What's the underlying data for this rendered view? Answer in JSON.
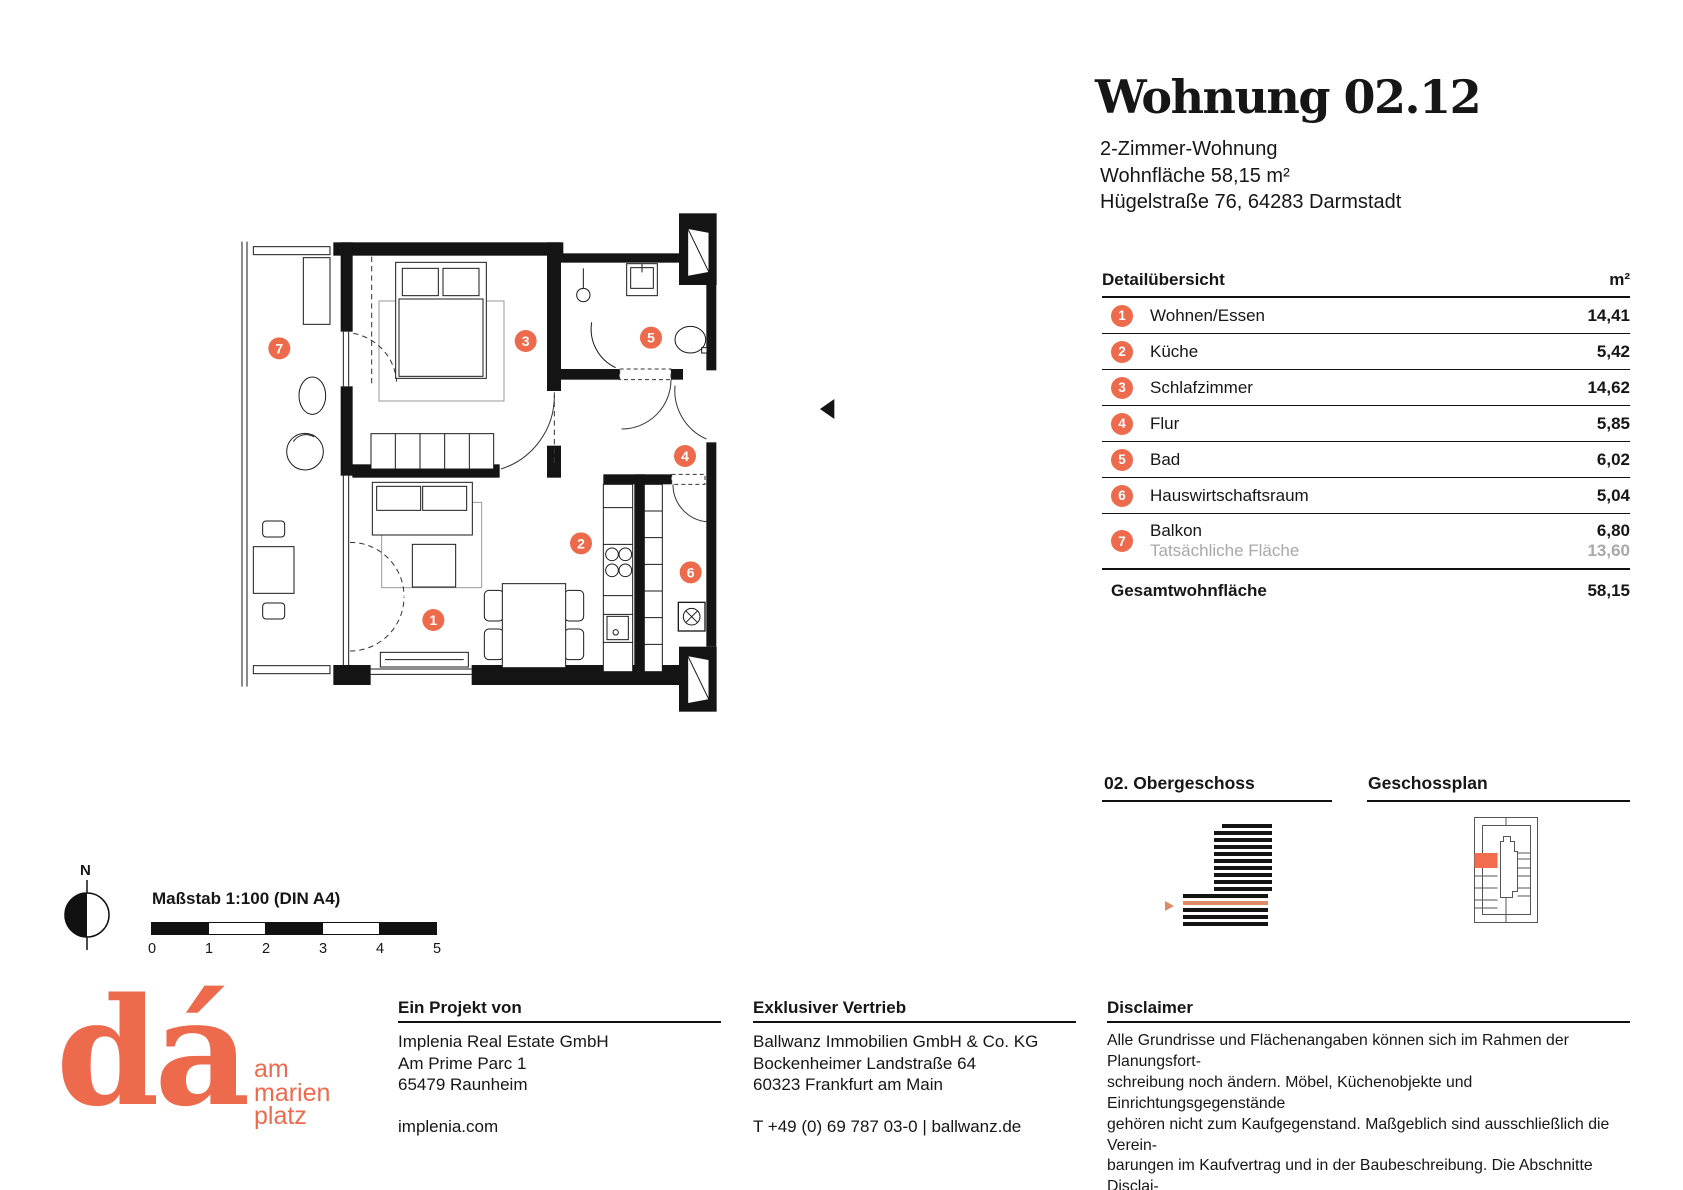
{
  "accent": "#ED6A4C",
  "stripe_orange": "#DE8A66",
  "header": {
    "title": "Wohnung 02.12",
    "lines": [
      "2-Zimmer-Wohnung",
      "Wohnfläche 58,15 m²",
      "Hügelstraße 76, 64283 Darmstadt"
    ]
  },
  "table": {
    "title": "Detailübersicht",
    "unit": "m²",
    "rows": [
      {
        "num": "1",
        "label": "Wohnen/Essen",
        "value": "14,41"
      },
      {
        "num": "2",
        "label": "Küche",
        "value": "5,42"
      },
      {
        "num": "3",
        "label": "Schlafzimmer",
        "value": "14,62"
      },
      {
        "num": "4",
        "label": "Flur",
        "value": "5,85"
      },
      {
        "num": "5",
        "label": "Bad",
        "value": "6,02"
      },
      {
        "num": "6",
        "label": "Hauswirtschaftsraum",
        "value": "5,04"
      },
      {
        "num": "7",
        "label": "Balkon",
        "value": "6,80",
        "sublabel": "Tatsächliche Fläche",
        "subvalue": "13,60"
      }
    ],
    "total_label": "Gesamtwohnfläche",
    "total_value": "58,15"
  },
  "sections": {
    "floor": "02. Obergeschoss",
    "plan": "Geschossplan"
  },
  "scale": {
    "compass": "N",
    "label": "Maßstab 1:100 (DIN A4)",
    "ticks": [
      "0",
      "1",
      "2",
      "3",
      "4",
      "5"
    ]
  },
  "logo": {
    "mark": "dá",
    "tagline": [
      "am",
      "marien",
      "platz"
    ]
  },
  "footer": {
    "project": {
      "title": "Ein Projekt von",
      "lines": [
        "Implenia Real Estate GmbH",
        "Am Prime Parc 1",
        "65479 Raunheim"
      ],
      "link": "implenia.com"
    },
    "sales": {
      "title": "Exklusiver Vertrieb",
      "lines": [
        "Ballwanz Immobilien GmbH & Co. KG",
        "Bockenheimer Landstraße 64",
        "60323 Frankfurt am Main"
      ],
      "link": "T +49 (0) 69 787 03-0 | ballwanz.de"
    },
    "disclaimer": {
      "title": "Disclaimer",
      "lines": [
        "Alle Grundrisse und Flächenangaben können sich im Rahmen der Planungsfort-",
        "schreibung noch ändern. Möbel, Küchenobjekte und Einrichtungsgegenstände",
        "gehören nicht zum Kaufgegenstand. Maßgeblich sind ausschließlich die Verein-",
        "barungen im Kaufvertrag und in der Baubeschreibung. Die Abschnitte Disclai-",
        "mer und Haftung im Exposé finden entsprechend Anwendung. Stand: Juli 2025"
      ]
    }
  }
}
